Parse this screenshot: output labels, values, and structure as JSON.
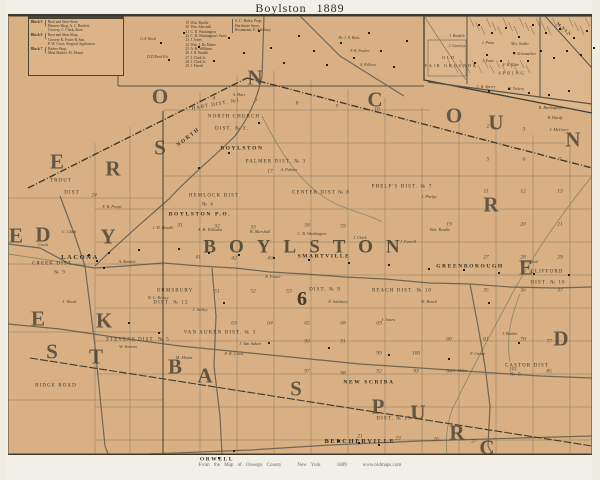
{
  "title": "Boylston  1889",
  "caption": {
    "source": "From the Map of Oswego County",
    "state": "New York",
    "year": "1889",
    "site": "www.oldmaps.com"
  },
  "colors": {
    "paper": "#d9b083",
    "frame_line": "#3c382f",
    "grid_line": "#6e6652",
    "road_line": "#5c594e",
    "ink_text": "#3c372c",
    "big_letter": "#4a4437"
  },
  "directory_box": {
    "blocks": [
      {
        "label": "Block 5",
        "lines": [
          "Boot and Shoe Store,",
          "Harness Shop, A. C. Burdett,",
          "Grocery, C. Clark, Store."
        ]
      },
      {
        "label": "Block 6",
        "lines": [
          "Boot and Shoe Shop,",
          "Grocery R. Foster & Son,",
          "P. W. Cross, Surgical Appliances."
        ]
      },
      {
        "label": "Block 7",
        "lines": [
          "Barber Shop,",
          "Meat Market, M. Mount."
        ]
      }
    ]
  },
  "business_list": [
    {
      "n": "19",
      "name": "Wm. Beadle"
    },
    {
      "n": "20",
      "name": "Wm. Marshall"
    },
    {
      "n": "21",
      "name": "C. B. Washington"
    },
    {
      "n": "22",
      "name": "C. B. Washington's Store"
    },
    {
      "n": "23",
      "name": "J. Jones"
    },
    {
      "n": "24",
      "name": "Wm. J. De Maine"
    },
    {
      "n": "25",
      "name": "A. H. Williams"
    },
    {
      "n": "26",
      "name": "J. H. Beadle"
    },
    {
      "n": "27",
      "name": "J. Clark Jr."
    },
    {
      "n": "28",
      "name": "J. Clark Jr."
    },
    {
      "n": "29",
      "name": "J. Farrell"
    }
  ],
  "haley_block": [
    "S. C. Haley, Prop.",
    "Hardware Store,",
    "Restaurant, E. Salsbury."
  ],
  "big_letters": [
    {
      "t": "O",
      "x": 152,
      "y": 81
    },
    {
      "t": "N",
      "x": 247,
      "y": 62
    },
    {
      "t": "C",
      "x": 367,
      "y": 84
    },
    {
      "t": "O",
      "x": 446,
      "y": 100
    },
    {
      "t": "U",
      "x": 488,
      "y": 107
    },
    {
      "t": "N",
      "x": 565,
      "y": 124
    },
    {
      "t": "E",
      "x": 49,
      "y": 146
    },
    {
      "t": "R",
      "x": 105,
      "y": 153
    },
    {
      "t": "S",
      "x": 152,
      "y": 132
    },
    {
      "t": "D",
      "x": 35,
      "y": 219
    },
    {
      "t": "Y",
      "x": 100,
      "y": 221
    },
    {
      "t": "E",
      "x": 8,
      "y": 220
    },
    {
      "t": "K",
      "x": 96,
      "y": 305
    },
    {
      "t": "E",
      "x": 30,
      "y": 303
    },
    {
      "t": "S",
      "x": 44,
      "y": 336
    },
    {
      "t": "T",
      "x": 88,
      "y": 341
    },
    {
      "t": "B",
      "x": 167,
      "y": 351
    },
    {
      "t": "A",
      "x": 197,
      "y": 360
    },
    {
      "t": "S",
      "x": 288,
      "y": 373
    },
    {
      "t": "P",
      "x": 370,
      "y": 391
    },
    {
      "t": "U",
      "x": 410,
      "y": 397
    },
    {
      "t": "R",
      "x": 449,
      "y": 417
    },
    {
      "t": "C",
      "x": 479,
      "y": 432
    },
    {
      "t": "R",
      "x": 483,
      "y": 189
    },
    {
      "t": "E",
      "x": 518,
      "y": 252
    },
    {
      "t": "D",
      "x": 553,
      "y": 323
    }
  ],
  "giant_word": {
    "t": "BOYLSTON",
    "x": 300,
    "y": 231
  },
  "township_number": {
    "t": "6",
    "x": 294,
    "y": 283
  },
  "places": [
    {
      "t": "LACONA",
      "x": 72,
      "y": 242,
      "c": "place"
    },
    {
      "t": "NORTH",
      "x": 181,
      "y": 122,
      "c": "place",
      "r": -38,
      "s": 5.5
    },
    {
      "t": "BOYLSTON",
      "x": 234,
      "y": 133,
      "c": "place",
      "s": 5.5
    },
    {
      "t": "BOYLSTON P.O.",
      "x": 192,
      "y": 199,
      "c": "place",
      "s": 5.5
    },
    {
      "t": "SMARTVILLE",
      "x": 316,
      "y": 241,
      "c": "place",
      "s": 5.5
    },
    {
      "t": "GREENBOROUGH",
      "x": 462,
      "y": 251,
      "c": "place",
      "s": 5.5
    },
    {
      "t": "NEW SCRIBA",
      "x": 361,
      "y": 367,
      "c": "place",
      "s": 5.5
    },
    {
      "t": "BEECHERVILLE",
      "x": 352,
      "y": 426,
      "c": "place"
    },
    {
      "t": "ORWELL",
      "x": 209,
      "y": 444,
      "c": "place",
      "s": 5.5
    }
  ],
  "districts": [
    {
      "t": "HART DIST. №1",
      "x": 208,
      "y": 89,
      "r": -10
    },
    {
      "t": "NORTH CHURCH",
      "x": 226,
      "y": 101
    },
    {
      "t": "DIST. № 2.",
      "x": 224,
      "y": 113
    },
    {
      "t": "PALMER DIST. № 3",
      "x": 268,
      "y": 146
    },
    {
      "t": "HEMLOCK DIST",
      "x": 206,
      "y": 180
    },
    {
      "t": "№ 4",
      "x": 200,
      "y": 189
    },
    {
      "t": "CENTER DIST № 8",
      "x": 313,
      "y": 177
    },
    {
      "t": "PHELP'S DIST. № 7",
      "x": 394,
      "y": 171
    },
    {
      "t": "ORMSBURY",
      "x": 167,
      "y": 275
    },
    {
      "t": "DIST. № 12",
      "x": 163,
      "y": 287
    },
    {
      "t": "DIST. № 9",
      "x": 317,
      "y": 274
    },
    {
      "t": "BEACH DIST. № 10",
      "x": 394,
      "y": 275
    },
    {
      "t": "CLIFFORD",
      "x": 539,
      "y": 256
    },
    {
      "t": "DIST. № 10",
      "x": 540,
      "y": 267
    },
    {
      "t": "VAN AUKEN DIST. № 3",
      "x": 212,
      "y": 317
    },
    {
      "t": "STEVENS DIST. № 5",
      "x": 130,
      "y": 324
    },
    {
      "t": "CASTOR DIST",
      "x": 519,
      "y": 350
    },
    {
      "t": "№ 5",
      "x": 508,
      "y": 359
    },
    {
      "t": "CREEK DIST",
      "x": 44,
      "y": 248
    },
    {
      "t": "№ 9",
      "x": 52,
      "y": 257
    },
    {
      "t": "TROUT",
      "x": 53,
      "y": 165
    },
    {
      "t": "DIST",
      "x": 64,
      "y": 177
    },
    {
      "t": "DIST. № 15",
      "x": 386,
      "y": 403
    },
    {
      "t": "RIDGE ROAD",
      "x": 48,
      "y": 370
    }
  ],
  "streets": [
    {
      "t": "SPRING",
      "x": 504,
      "y": 58
    },
    {
      "t": "MAIN",
      "x": 556,
      "y": 14,
      "r": 40
    },
    {
      "t": "OLD",
      "x": 441,
      "y": 42,
      "s": 4.2
    },
    {
      "t": "FAIR GROUNDS",
      "x": 443,
      "y": 50,
      "s": 4.2
    }
  ],
  "inset_names": [
    {
      "t": "J. Burdick",
      "x": 449,
      "y": 21
    },
    {
      "t": "J. Gurnsey",
      "x": 449,
      "y": 31
    },
    {
      "t": "J. Prass",
      "x": 480,
      "y": 28
    },
    {
      "t": "Mrs. Sadler",
      "x": 512,
      "y": 29
    },
    {
      "t": "J. Schumacher",
      "x": 517,
      "y": 39
    },
    {
      "t": "J. Estes",
      "x": 480,
      "y": 46
    },
    {
      "t": "F. B. Kline",
      "x": 503,
      "y": 50
    },
    {
      "t": "C. K. Sperry",
      "x": 478,
      "y": 72
    },
    {
      "t": "W. Vickery",
      "x": 508,
      "y": 74
    }
  ],
  "top_names": [
    {
      "t": "G.A.Wood",
      "x": 140,
      "y": 24
    },
    {
      "t": "D.D.Reed Est.",
      "x": 150,
      "y": 42
    },
    {
      "t": "Dr. J. N. Betts",
      "x": 341,
      "y": 23
    },
    {
      "t": "F. B. Poulter",
      "x": 352,
      "y": 36
    },
    {
      "t": "A. Fellows",
      "x": 360,
      "y": 50
    }
  ],
  "farm_names": [
    {
      "t": "Creek",
      "x": 35,
      "y": 229
    },
    {
      "t": "W. C. Kelsey",
      "x": 150,
      "y": 282
    },
    {
      "t": "J. Ashley",
      "x": 192,
      "y": 294
    },
    {
      "t": "F. B. Pruyn",
      "x": 104,
      "y": 191
    },
    {
      "t": "R. Burlingham",
      "x": 543,
      "y": 92
    },
    {
      "t": "B. Hardy",
      "x": 547,
      "y": 102
    },
    {
      "t": "J. McGuire",
      "x": 551,
      "y": 114
    },
    {
      "t": "J. Barber",
      "x": 502,
      "y": 318
    },
    {
      "t": "F. Castor",
      "x": 470,
      "y": 338
    },
    {
      "t": "G. Miller",
      "x": 452,
      "y": 355
    },
    {
      "t": "J. H. Beadle",
      "x": 155,
      "y": 212
    },
    {
      "t": "A. H. Williams",
      "x": 202,
      "y": 214
    },
    {
      "t": "W. Marshall",
      "x": 252,
      "y": 216
    },
    {
      "t": "C. B. Washington",
      "x": 304,
      "y": 218
    },
    {
      "t": "J. Clark",
      "x": 352,
      "y": 222
    },
    {
      "t": "J. Farrell",
      "x": 400,
      "y": 226
    },
    {
      "t": "Wm. Beadle",
      "x": 432,
      "y": 214
    },
    {
      "t": "R. Foster",
      "x": 265,
      "y": 261
    },
    {
      "t": "E. Salsbury",
      "x": 330,
      "y": 286
    },
    {
      "t": "J. Jones",
      "x": 380,
      "y": 304
    },
    {
      "t": "W. Stevens",
      "x": 120,
      "y": 331
    },
    {
      "t": "J. Van Auken",
      "x": 242,
      "y": 328
    },
    {
      "t": "P. W. Cross",
      "x": 226,
      "y": 338
    },
    {
      "t": "M. Mount",
      "x": 176,
      "y": 342
    },
    {
      "t": "A. Palmer",
      "x": 281,
      "y": 154
    },
    {
      "t": "J. Phelps",
      "x": 421,
      "y": 181
    },
    {
      "t": "S. Hart",
      "x": 231,
      "y": 79
    },
    {
      "t": "J. Clifford",
      "x": 521,
      "y": 246
    },
    {
      "t": "D. Beach",
      "x": 421,
      "y": 286
    },
    {
      "t": "J. Wood",
      "x": 61,
      "y": 286
    },
    {
      "t": "C. Clark",
      "x": 61,
      "y": 216
    },
    {
      "t": "A. Burdett",
      "x": 119,
      "y": 246
    }
  ],
  "lot_numbers": [
    {
      "t": "4",
      "x": 206,
      "y": 83
    },
    {
      "t": "7",
      "x": 248,
      "y": 86
    },
    {
      "t": "8",
      "x": 289,
      "y": 88
    },
    {
      "t": "9",
      "x": 329,
      "y": 91
    },
    {
      "t": "10",
      "x": 369,
      "y": 94
    },
    {
      "t": "2",
      "x": 480,
      "y": 111
    },
    {
      "t": "3",
      "x": 516,
      "y": 114
    },
    {
      "t": "5",
      "x": 480,
      "y": 144
    },
    {
      "t": "6",
      "x": 516,
      "y": 144
    },
    {
      "t": "7",
      "x": 552,
      "y": 144
    },
    {
      "t": "11",
      "x": 478,
      "y": 176
    },
    {
      "t": "12",
      "x": 515,
      "y": 176
    },
    {
      "t": "13",
      "x": 552,
      "y": 176
    },
    {
      "t": "17",
      "x": 262,
      "y": 156
    },
    {
      "t": "19",
      "x": 441,
      "y": 209
    },
    {
      "t": "20",
      "x": 515,
      "y": 209
    },
    {
      "t": "21",
      "x": 552,
      "y": 209
    },
    {
      "t": "24",
      "x": 86,
      "y": 180
    },
    {
      "t": "27",
      "x": 478,
      "y": 242
    },
    {
      "t": "28",
      "x": 515,
      "y": 242
    },
    {
      "t": "29",
      "x": 552,
      "y": 242
    },
    {
      "t": "31",
      "x": 172,
      "y": 210
    },
    {
      "t": "32",
      "x": 209,
      "y": 211
    },
    {
      "t": "33",
      "x": 245,
      "y": 212
    },
    {
      "t": "35",
      "x": 478,
      "y": 275
    },
    {
      "t": "36",
      "x": 515,
      "y": 275
    },
    {
      "t": "37",
      "x": 552,
      "y": 275
    },
    {
      "t": "41",
      "x": 190,
      "y": 242
    },
    {
      "t": "42",
      "x": 226,
      "y": 243
    },
    {
      "t": "43",
      "x": 262,
      "y": 243
    },
    {
      "t": "51",
      "x": 209,
      "y": 276
    },
    {
      "t": "52",
      "x": 245,
      "y": 276
    },
    {
      "t": "53",
      "x": 281,
      "y": 276
    },
    {
      "t": "58",
      "x": 299,
      "y": 210
    },
    {
      "t": "59",
      "x": 335,
      "y": 211
    },
    {
      "t": "60",
      "x": 441,
      "y": 324
    },
    {
      "t": "61",
      "x": 478,
      "y": 324
    },
    {
      "t": "63",
      "x": 226,
      "y": 308
    },
    {
      "t": "64",
      "x": 262,
      "y": 308
    },
    {
      "t": "65",
      "x": 299,
      "y": 308
    },
    {
      "t": "68",
      "x": 335,
      "y": 308
    },
    {
      "t": "69",
      "x": 371,
      "y": 308
    },
    {
      "t": "70",
      "x": 515,
      "y": 324
    },
    {
      "t": "77",
      "x": 541,
      "y": 326
    },
    {
      "t": "85",
      "x": 541,
      "y": 356
    },
    {
      "t": "90",
      "x": 299,
      "y": 326
    },
    {
      "t": "91",
      "x": 335,
      "y": 326
    },
    {
      "t": "92",
      "x": 371,
      "y": 356
    },
    {
      "t": "93",
      "x": 408,
      "y": 356
    },
    {
      "t": "94",
      "x": 441,
      "y": 356
    },
    {
      "t": "97",
      "x": 299,
      "y": 356
    },
    {
      "t": "98",
      "x": 335,
      "y": 358
    },
    {
      "t": "99",
      "x": 371,
      "y": 338
    },
    {
      "t": "100",
      "x": 408,
      "y": 338
    },
    {
      "t": "101",
      "x": 505,
      "y": 354
    },
    {
      "t": "21",
      "x": 352,
      "y": 421
    },
    {
      "t": "23",
      "x": 390,
      "y": 423
    },
    {
      "t": "26",
      "x": 428,
      "y": 424
    },
    {
      "t": "27",
      "x": 466,
      "y": 426
    }
  ],
  "houses": [
    [
      152,
      26
    ],
    [
      160,
      43
    ],
    [
      175,
      16
    ],
    [
      190,
      30
    ],
    [
      205,
      44
    ],
    [
      220,
      21
    ],
    [
      235,
      36
    ],
    [
      250,
      14
    ],
    [
      262,
      31
    ],
    [
      275,
      46
    ],
    [
      290,
      19
    ],
    [
      305,
      34
    ],
    [
      318,
      48
    ],
    [
      332,
      26
    ],
    [
      345,
      41
    ],
    [
      360,
      16
    ],
    [
      372,
      34
    ],
    [
      385,
      50
    ],
    [
      398,
      24
    ],
    [
      470,
      8
    ],
    [
      483,
      16
    ],
    [
      497,
      11
    ],
    [
      510,
      20
    ],
    [
      524,
      8
    ],
    [
      537,
      16
    ],
    [
      551,
      12
    ],
    [
      565,
      21
    ],
    [
      578,
      14
    ],
    [
      585,
      31
    ],
    [
      572,
      38
    ],
    [
      558,
      34
    ],
    [
      545,
      41
    ],
    [
      532,
      34
    ],
    [
      519,
      44
    ],
    [
      505,
      36
    ],
    [
      492,
      44
    ],
    [
      478,
      38
    ],
    [
      466,
      46
    ],
    [
      480,
      74
    ],
    [
      500,
      72
    ],
    [
      520,
      76
    ],
    [
      540,
      78
    ],
    [
      560,
      74
    ],
    [
      100,
      236
    ],
    [
      130,
      233
    ],
    [
      170,
      232
    ],
    [
      200,
      236
    ],
    [
      230,
      238
    ],
    [
      265,
      241
    ],
    [
      300,
      243
    ],
    [
      340,
      246
    ],
    [
      380,
      248
    ],
    [
      420,
      252
    ],
    [
      455,
      253
    ],
    [
      490,
      256
    ],
    [
      525,
      257
    ],
    [
      560,
      258
    ],
    [
      88,
      244
    ],
    [
      95,
      251
    ],
    [
      80,
      238
    ],
    [
      220,
      136
    ],
    [
      250,
      106
    ],
    [
      190,
      151
    ],
    [
      215,
      286
    ],
    [
      260,
      326
    ],
    [
      320,
      331
    ],
    [
      380,
      338
    ],
    [
      440,
      342
    ],
    [
      120,
      306
    ],
    [
      150,
      316
    ],
    [
      480,
      286
    ],
    [
      510,
      326
    ],
    [
      350,
      426
    ],
    [
      330,
      424
    ],
    [
      370,
      428
    ],
    [
      210,
      441
    ],
    [
      225,
      434
    ]
  ]
}
